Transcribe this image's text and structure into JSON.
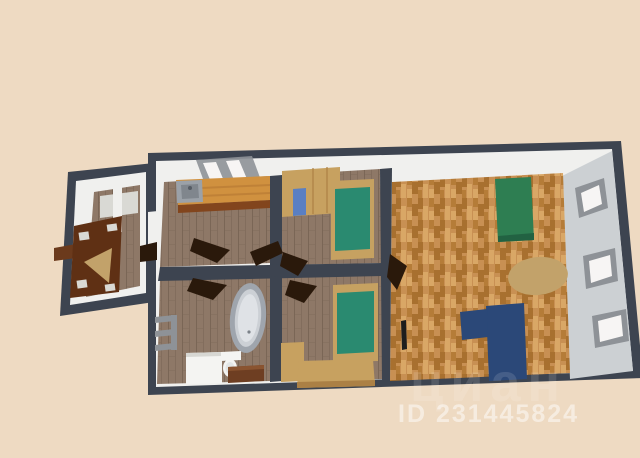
{
  "watermark": {
    "brand": "циан",
    "id": "ID 231445824",
    "color": "#ffffff"
  },
  "colors": {
    "background": "#eedac2",
    "wall_dark": "#3d4450",
    "wall_face_white": "#f0f0ee",
    "wall_face_gray": "#ccd0d3",
    "shelf_gray": "#d9d9d4",
    "floor_plank": "#8e7867",
    "floor_plank_line": "#7a6656",
    "parquet_base": "#c89053",
    "parquet_dark": "#a8702f",
    "parquet_mid": "#b57c38",
    "parquet_light": "#d9a766",
    "counter": "#d0913f",
    "counter_edge": "#82451d",
    "counter_line": "#b87a34",
    "sink": "#9ba1a8",
    "sink_inner": "#80868d",
    "faucet": "#555b63",
    "window_frame": "#8e9297",
    "window_glass": "#f7f5f4",
    "wardrobe_tan": "#c7a160",
    "wardrobe_blue": "#5a7fc2",
    "wardrobe_line": "#ab8045",
    "bed_frame": "#c6a161",
    "mattress_teal": "#2a8a70",
    "sofa_green": "#2e7e52",
    "sofa_green_dark": "#226242",
    "sofa_blue": "#2b4878",
    "rug_tan": "#c2a26a",
    "tub_rim": "#9fa5ad",
    "tub_fill": "#ccd0d5",
    "tub_inner": "#dfe2e6",
    "drain": "#7c8289",
    "fixture_white": "#f4f4f2",
    "fixture_edge": "#d7d7d3",
    "toilet_seat": "#e3e6e6",
    "cabinet_brown": "#6e3e22",
    "cabinet_light": "#8a5430",
    "door_leaf": "#2a190b",
    "annex_wardrobe": "#5f3014",
    "annex_ledge": "#6b3a1c",
    "tv_black": "#1d1d1d"
  }
}
